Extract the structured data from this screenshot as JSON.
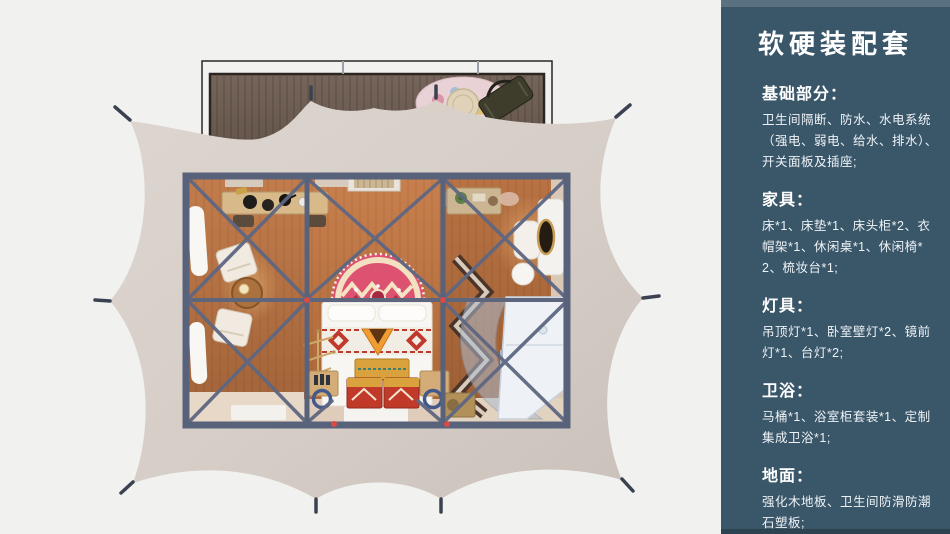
{
  "window": {
    "width": 950,
    "height": 534
  },
  "colors": {
    "page_bg": "#f1f1f0",
    "sidebar_bg": "#3a5669",
    "sidebar_text": "#eef3f6",
    "tent_canvas": "#d8cfc9",
    "deck_wood": "#6a5a4f",
    "frame_beam": "#59627b",
    "wood_floor": "#b5713f",
    "rug_pink": "#dc5270",
    "chest_red": "#c13a29",
    "bathroom_pod": "#eef1f6",
    "joint_red": "#d94a43"
  },
  "sidebar": {
    "title": "软硬装配套",
    "sections": [
      {
        "heading": "基础部分：",
        "body": "卫生间隔断、防水、水电系统（强电、弱电、给水、排水）、开关面板及插座;"
      },
      {
        "heading": "家具：",
        "body": "床*1、床垫*1、床头柜*2、衣帽架*1、休闲桌*1、休闲椅*2、梳妆台*1;"
      },
      {
        "heading": "灯具：",
        "body": "吊顶灯*1、卧室壁灯*2、镜前灯*1、台灯*2;"
      },
      {
        "heading": "卫浴：",
        "body": "马桶*1、浴室柜套装*1、定制集成卫浴*1;"
      },
      {
        "heading": "地面：",
        "body": "强化木地板、卫生间防滑防潮石塑板;"
      }
    ]
  }
}
